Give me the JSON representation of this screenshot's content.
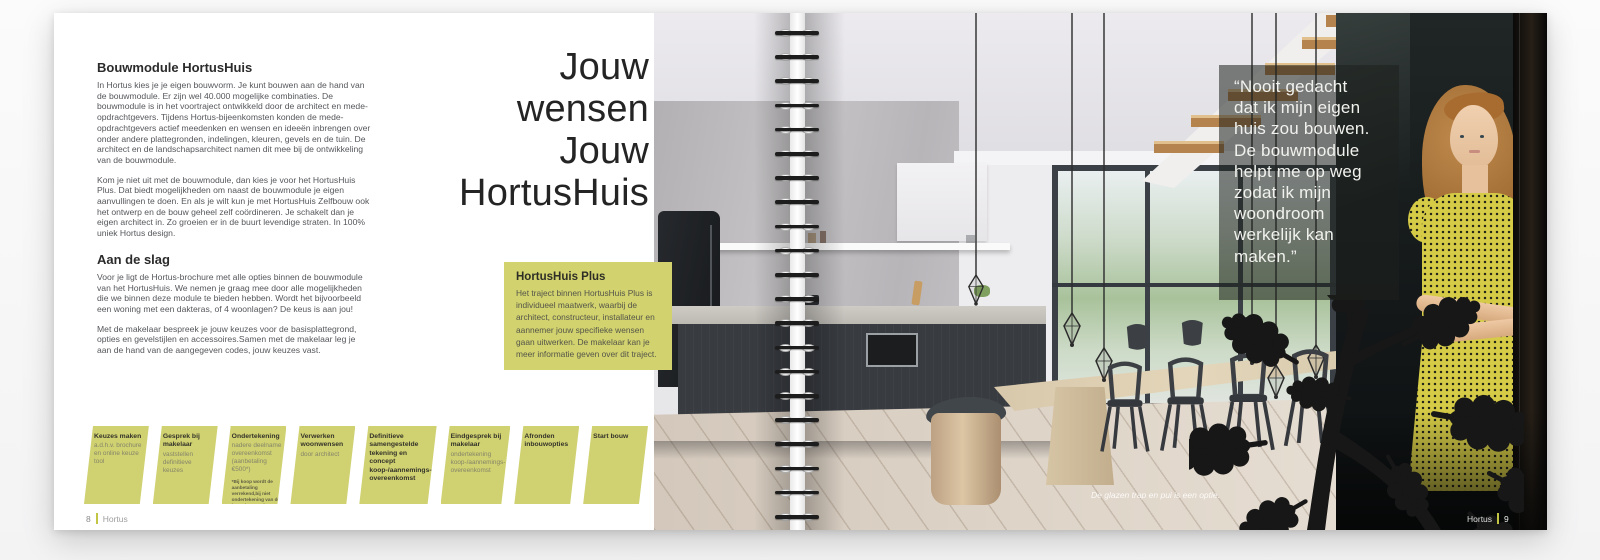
{
  "left_page": {
    "section1_heading": "Bouwmodule HortusHuis",
    "p1": "In Hortus kies je je eigen bouwvorm. Je kunt bouwen aan de hand van de bouwmodule. Er zijn wel 40.000 mogelijke combinaties. De bouwmodule is in het voortraject ontwikkeld door de architect en mede-opdrachtgevers. Tijdens Hortus-bijeenkomsten konden de mede-opdrachtgevers actief meedenken en wensen en ideeën inbrengen over onder andere plattegronden, indelingen, kleuren, gevels en de tuin. De architect en de landschapsarchitect namen dit mee bij de ontwikkeling van de bouwmodule.",
    "p2": "Kom je niet uit met de bouwmodule, dan kies je voor het HortusHuis Plus. Dat biedt mogelijkheden om naast de bouwmodule je eigen aanvullingen te doen. En als je wilt kun je met HortusHuis Zelfbouw ook het ontwerp en de bouw geheel zelf coördineren. Je schakelt dan je eigen architect in. Zo groeien er in de buurt levendige straten. In 100% uniek Hortus design.",
    "section2_heading": "Aan de slag",
    "p3": "Voor je ligt de Hortus-brochure met alle opties binnen de bouwmodule van het HortusHuis. We nemen je graag mee door alle mogelijkheden die we binnen deze module te bieden hebben. Wordt het bijvoorbeeld een woning met een dakteras, of 4 woonlagen? De keus is aan jou!",
    "p4": "Met de makelaar bespreek je jouw keuzes voor de basisplattegrond, opties en gevelstijlen en accessoires.Samen met de makelaar leg je aan de hand van de aangegeven codes, jouw keuzes vast.",
    "footer_number": "8",
    "footer_label": "Hortus"
  },
  "intro_title": "Jouw\nwensen\nJouw\nHortusHuis",
  "plus_box": {
    "heading": "HortusHuis Plus",
    "body": "Het traject binnen HortusHuis Plus is individueel maatwerk, waarbij de architect, constructeur, installateur en aannemer jouw specifieke wensen gaan uitwerken. De makelaar kan je meer informatie geven over dit traject."
  },
  "timeline": {
    "steps": [
      {
        "title": "Keuzes maken",
        "body": "a.d.h.v. brochure en online keuze tool",
        "note": ""
      },
      {
        "title": "Gesprek bij makelaar",
        "body": "vaststellen definitieve keuzes",
        "note": ""
      },
      {
        "title": "Ondertekening",
        "body": "nadere deelname overeenkomst (aanbetaling €500*)",
        "note": "*Bij koop wordt de aanbetaling verrekend,bij niet ondertekening van de koop-/aannemings-overeenkomst vervalt de aanbetaling."
      },
      {
        "title": "Verwerken woonwensen",
        "body": "door architect",
        "note": ""
      },
      {
        "title": "Definitieve samengestelde tekening en concept koop-/aannemings-overeenkomst",
        "body": "",
        "note": ""
      },
      {
        "title": "Eindgesprek bij makelaar",
        "body": "ondertekening koop-/aannemings-overeenkomst",
        "note": ""
      },
      {
        "title": "Afronden inbouwopties",
        "body": "",
        "note": ""
      },
      {
        "title": "Start bouw",
        "body": "",
        "note": ""
      }
    ]
  },
  "photo": {
    "quote": "“Nooit gedacht\ndat ik mijn eigen\nhuis zou bouwen.\nDe bouwmodule\nhelpt me op weg\nzodat ik mijn\nwoondroom\nwerkelijk kan\nmaken.”",
    "caption": "De glazen trap en pui is een optie."
  },
  "right_footer": {
    "label": "Hortus",
    "number": "9"
  },
  "colors": {
    "accent_green": "#d2d36e",
    "timeline_green": "#d0d170",
    "footer_bar_green": "#c3c644",
    "quote_overlay": "#1e211e",
    "dress_yellow": "#d5cb47"
  }
}
